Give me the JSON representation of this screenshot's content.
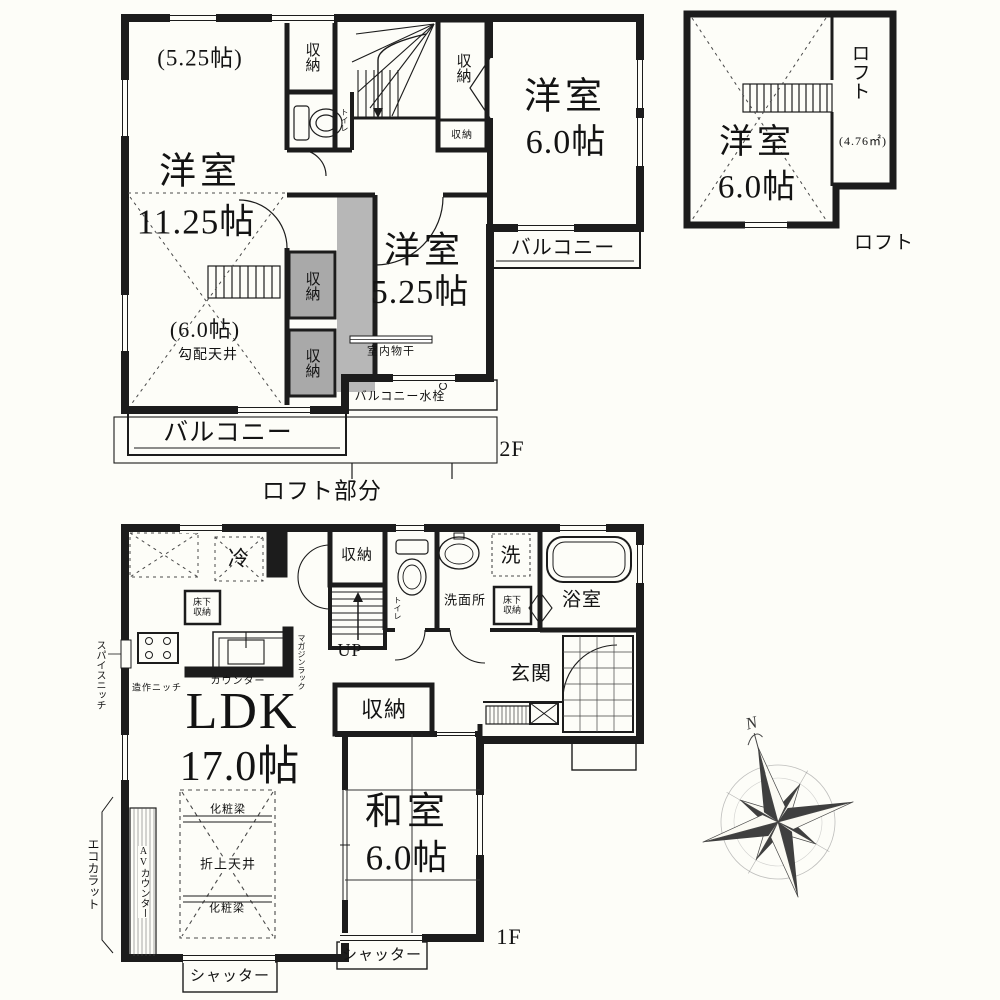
{
  "floor2": {
    "label": "2F",
    "loft_section": "ロフト部分",
    "room_large": {
      "name": "洋室",
      "size": "11.25帖",
      "upper_sub": "(5.25帖)",
      "lower_sub": "(6.0帖)",
      "ceiling_note": "勾配天井"
    },
    "room_south": {
      "name": "洋室",
      "size": "5.25帖"
    },
    "room_east": {
      "name": "洋室",
      "size": "6.0帖"
    },
    "closets": [
      "収納",
      "収納",
      "収納",
      "収納",
      "収納"
    ],
    "toilet": "トイレ",
    "balcony_east": "バルコニー",
    "balcony_south": "バルコニー",
    "indoor_drying": "室内物干",
    "balcony_faucet": "バルコニー水栓"
  },
  "loft": {
    "room_name": "洋室",
    "room_size": "6.0帖",
    "label_vertical": "ロフト",
    "area": "(4.76㎡)",
    "caption": "ロフト"
  },
  "floor1": {
    "label": "1F",
    "ldk": {
      "name": "LDK",
      "size": "17.0帖",
      "beam_upper": "化粧梁",
      "beam_lower": "化粧梁",
      "ceiling": "折上天井"
    },
    "japanese_room": {
      "name": "和室",
      "size": "6.0帖"
    },
    "kitchen": {
      "fridge": "冷",
      "underfloor_storage": "床下収納",
      "counter": "カウンター",
      "magazine_rack": "マガジンラック",
      "spice_niche": "スパイスニッチ",
      "niche": "造作ニッチ"
    },
    "closet_upper": "収納",
    "closet_middle": "収納",
    "stairs_up": "UP",
    "toilet": "トイレ",
    "washroom": "洗面所",
    "laundry": "洗",
    "underfloor_storage2": "床下収納",
    "bathroom": "浴室",
    "entrance": "玄関",
    "ecocarat": "エコカラット",
    "av_counter": "AVカウンター",
    "shutters": [
      "シャッター",
      "シャッター"
    ]
  },
  "compass": {
    "north": "N"
  }
}
